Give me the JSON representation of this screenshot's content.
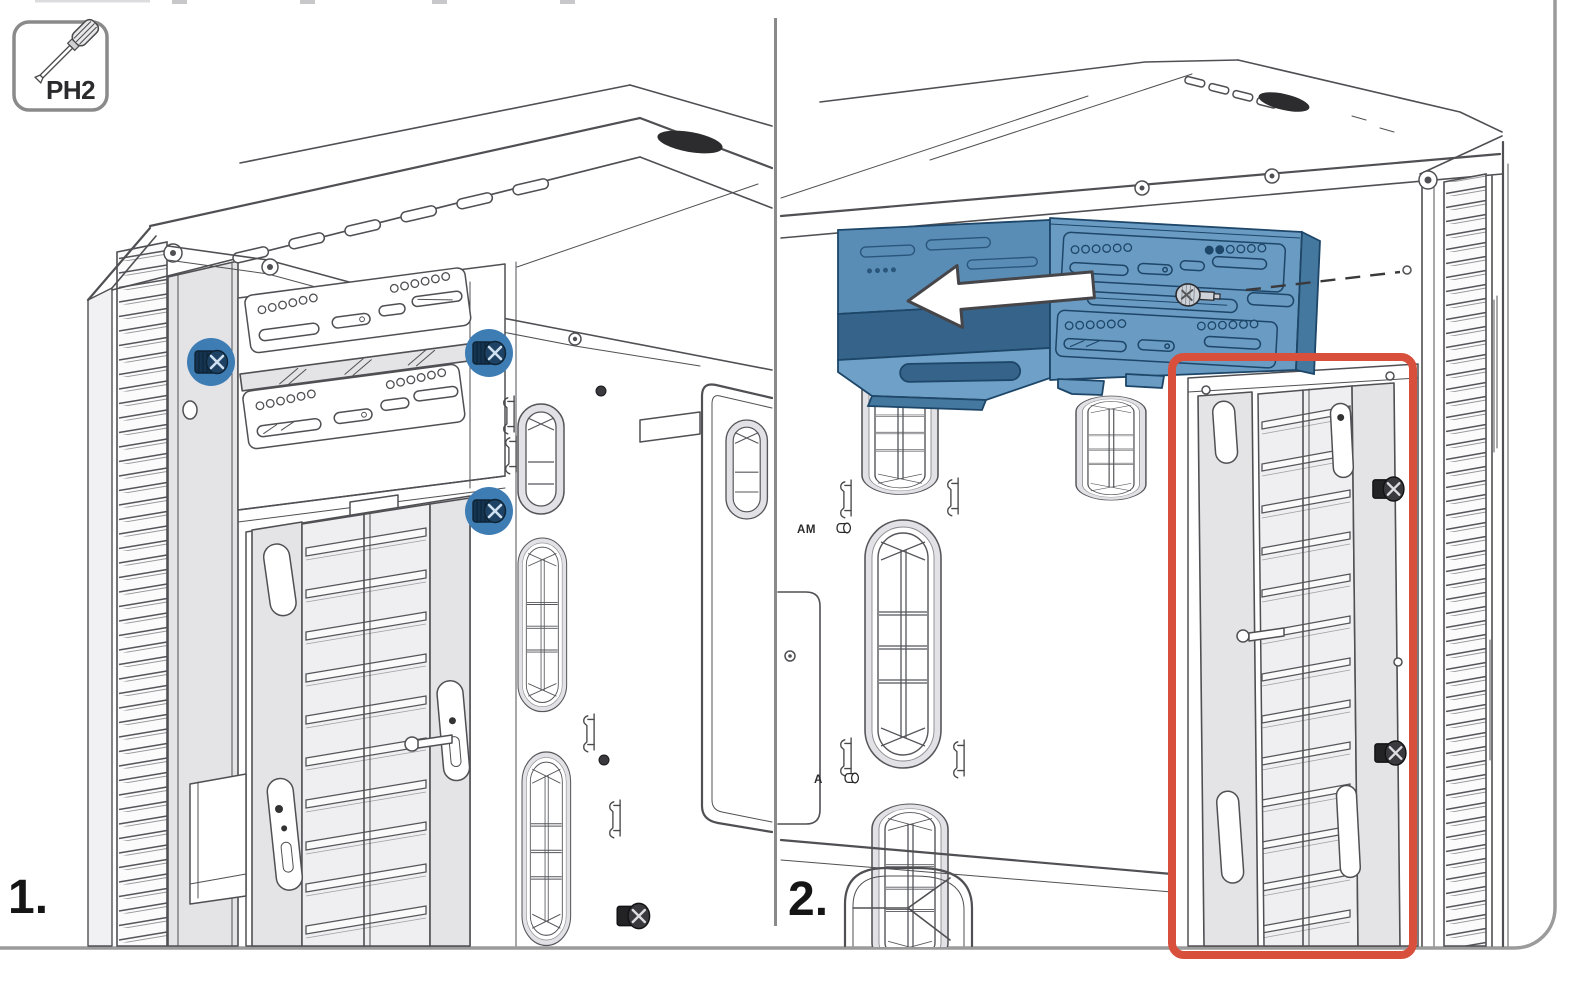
{
  "tool_badge": {
    "label": "PH2",
    "icon": "ph2-screwdriver-icon"
  },
  "steps": [
    {
      "label": "1."
    },
    {
      "label": "2."
    }
  ],
  "panel1": {
    "screw_highlights": [
      {
        "x": 211,
        "y": 362
      },
      {
        "x": 489,
        "y": 353
      },
      {
        "x": 489,
        "y": 511
      }
    ]
  },
  "panel2": {
    "labels": {
      "am": "AM",
      "a": "A"
    },
    "arrow_direction": "left"
  },
  "colors": {
    "line": "#505054",
    "frame": "#9b9b9b",
    "divider": "#8a8a8a",
    "highlight_blue": "#3e7cb4",
    "screw_navy": "#16344f",
    "cage_blue": "#699bc3",
    "cage_outline": "#1d4668",
    "highlight_red": "#d8503c",
    "arrow_fill": "#ffffff",
    "vent_dark": "#2c2c2e"
  }
}
